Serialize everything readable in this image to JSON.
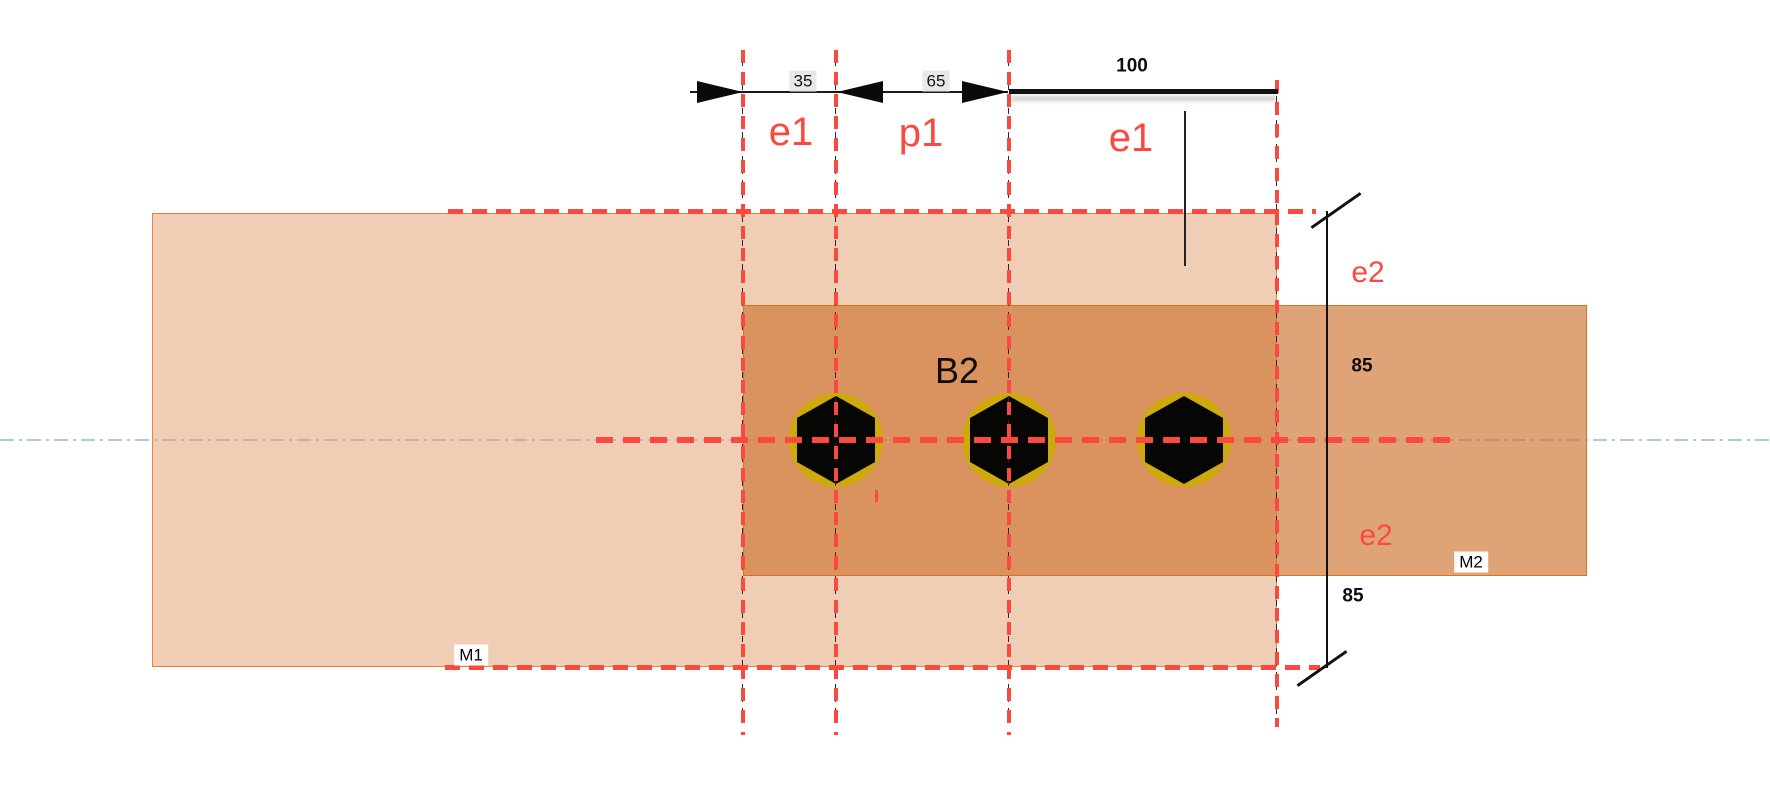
{
  "diagram": {
    "top_dimensions": {
      "dim_35": "35",
      "dim_65": "65",
      "dim_100": "100",
      "label_e1_left": "e1",
      "label_p1": "p1",
      "label_e1_right": "e1"
    },
    "side_dimensions": {
      "dim_85_upper": "85",
      "dim_85_lower": "85",
      "label_e2_upper": "e2",
      "label_e2_lower": "e2"
    },
    "parts": {
      "plate_m1": "M1",
      "plate_m2": "M2",
      "bolt_group": "B2"
    },
    "colors": {
      "accent_red": "#FB4940",
      "plate_m1_fill_over_white": "#EFCEB5",
      "plate_m2_fill_over_white": "#DD9C70",
      "plate_overlap_fill": "#CF8A59",
      "plate_edge_orange": "#E8823A",
      "bolt_ring_gold": "#CDA90B",
      "bolt_fill_black": "#060604",
      "centerline_blue": "#AECADF",
      "dim_chip_gray": "#E8E8E8"
    }
  }
}
